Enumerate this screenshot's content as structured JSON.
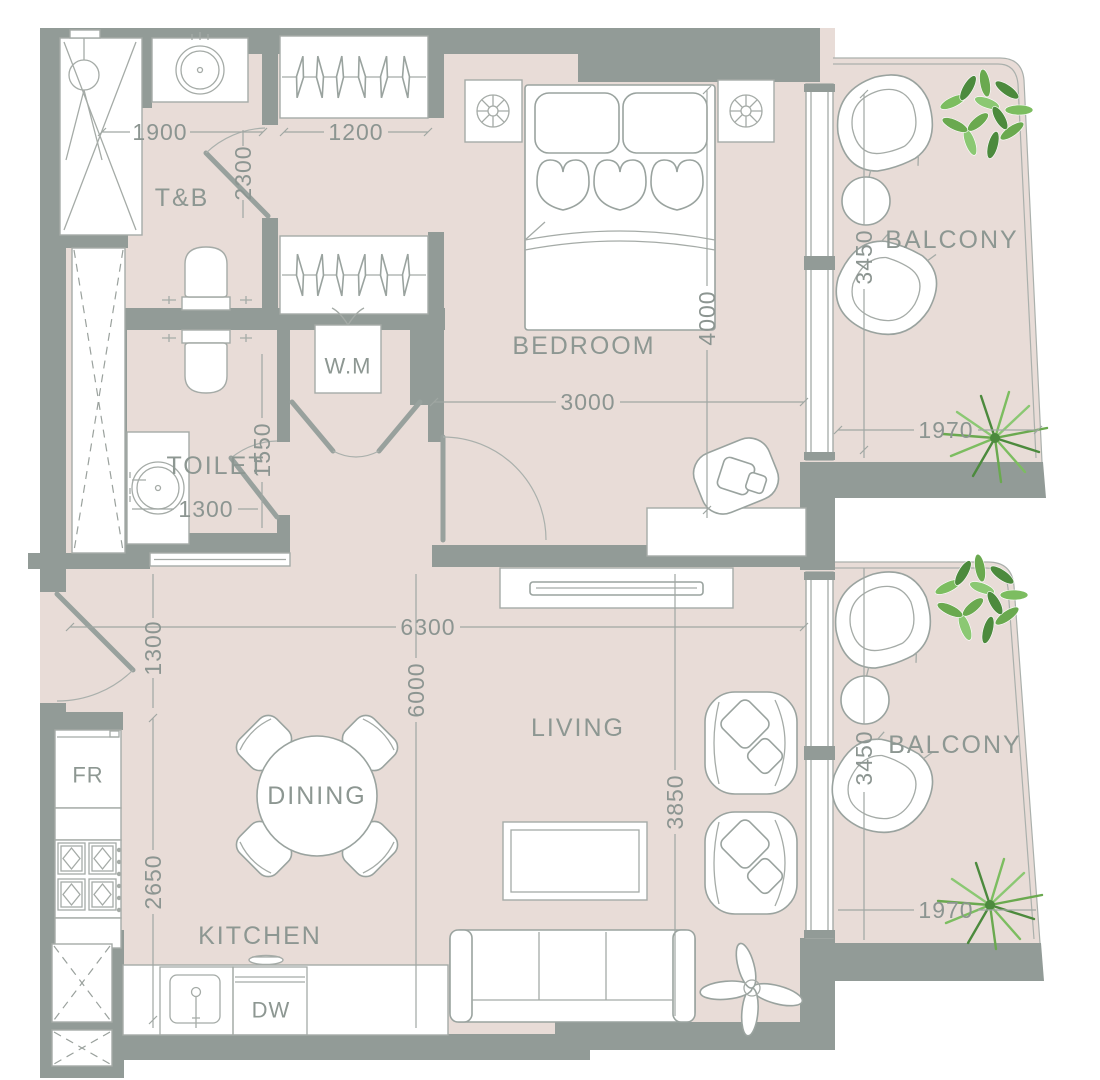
{
  "plan": {
    "room_labels": {
      "tb": "T&B",
      "toilet": "TOILET",
      "bedroom": "BEDROOM",
      "living": "LIVING",
      "dining": "DINING",
      "kitchen": "KITCHEN",
      "balcony_upper": "BALCONY",
      "balcony_lower": "BALCONY"
    },
    "fixture_labels": {
      "washing_machine": "W.M",
      "fridge": "FR",
      "dishwasher": "DW"
    },
    "dimensions_mm": {
      "tb_width": "1900",
      "wardrobe_width": "1200",
      "tb_length": "2300",
      "bedroom_width": "3000",
      "bedroom_length": "4000",
      "upper_balcony_length": "3450",
      "upper_balcony_width": "1970",
      "toilet_length": "1550",
      "toilet_width": "1300",
      "overall_width": "6300",
      "entry_hall_width": "1300",
      "living_length": "6000",
      "living_width": "3850",
      "kitchen_length": "2650",
      "lower_balcony_length": "3450",
      "lower_balcony_width": "1970"
    },
    "colors": {
      "floor": "#e8dcd7",
      "wall": "#929b97",
      "furniture_line": "#a5aba7",
      "label_text": "#8d9792",
      "dimension_text": "#8c9591",
      "plant_green": "#6aa94f",
      "plant_green_dark": "#4c8a3d",
      "plant_green_light": "#8bc873",
      "plant_gray": "#b3b8b4"
    }
  }
}
